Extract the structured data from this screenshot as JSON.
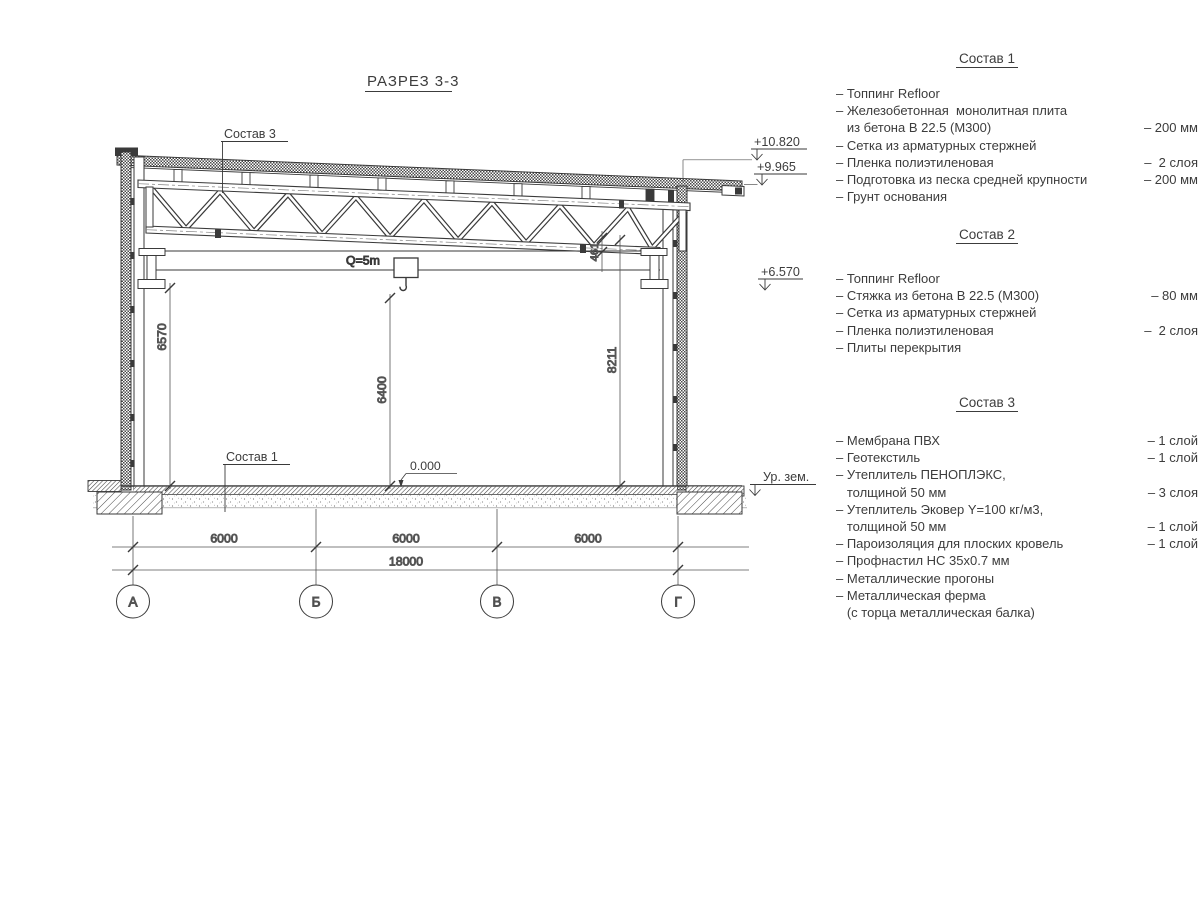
{
  "drawing": {
    "title": "РАЗРЕЗ 3-3",
    "crane_capacity": "Q=5m",
    "label_roof": "Состав 3",
    "label_floor": "Состав 1",
    "dim_left_height": "6570",
    "dim_hook_height": "6400",
    "dim_right_height": "8211",
    "dim_chord_offset": "461",
    "level_zero": "0.000",
    "span_dims": [
      "6000",
      "6000",
      "6000"
    ],
    "total_dim": "18000",
    "axes": [
      "А",
      "Б",
      "В",
      "Г"
    ],
    "elevations": {
      "roof_high": "+10.820",
      "roof_low": "+9.965",
      "crane_rail": "+6.570",
      "ground": "Ур. зем."
    }
  },
  "compositions": [
    {
      "heading": "Состав 1",
      "lines": [
        {
          "text": "– Топпинг Refloor",
          "value": ""
        },
        {
          "text": "– Железобетонная  монолитная плита",
          "value": ""
        },
        {
          "text": "   из бетона В 22.5 (М300)",
          "value": "– 200 мм"
        },
        {
          "text": "– Сетка из арматурных стержней",
          "value": ""
        },
        {
          "text": "– Пленка полиэтиленовая",
          "value": "–  2 слоя"
        },
        {
          "text": "– Подготовка из песка средней крупности",
          "value": "– 200 мм"
        },
        {
          "text": "– Грунт основания",
          "value": ""
        }
      ]
    },
    {
      "heading": "Состав 2",
      "lines": [
        {
          "text": "– Топпинг Refloor",
          "value": ""
        },
        {
          "text": "– Стяжка из бетона В 22.5 (М300)",
          "value": "– 80 мм"
        },
        {
          "text": "– Сетка из арматурных стержней",
          "value": ""
        },
        {
          "text": "– Пленка полиэтиленовая",
          "value": "–  2 слоя"
        },
        {
          "text": "– Плиты перекрытия",
          "value": ""
        }
      ]
    },
    {
      "heading": "Состав 3",
      "lines": [
        {
          "text": "– Мембрана ПВХ",
          "value": "– 1 слой"
        },
        {
          "text": "– Геотекстиль",
          "value": "– 1 слой"
        },
        {
          "text": "– Утеплитель ПЕНОПЛЭКС,",
          "value": ""
        },
        {
          "text": "   толщиной 50 мм",
          "value": "– 3 слоя"
        },
        {
          "text": "– Утеплитель Эковер Y=100 кг/м3,",
          "value": ""
        },
        {
          "text": "   толщиной 50 мм",
          "value": "– 1 слой"
        },
        {
          "text": "– Пароизоляция для плоских кровель",
          "value": "– 1 слой"
        },
        {
          "text": "– Профнастил НС 35х0.7 мм",
          "value": ""
        },
        {
          "text": "– Металлические прогоны",
          "value": ""
        },
        {
          "text": "– Металлическая ферма",
          "value": ""
        },
        {
          "text": "   (с торца металлическая балка)",
          "value": ""
        }
      ]
    }
  ]
}
